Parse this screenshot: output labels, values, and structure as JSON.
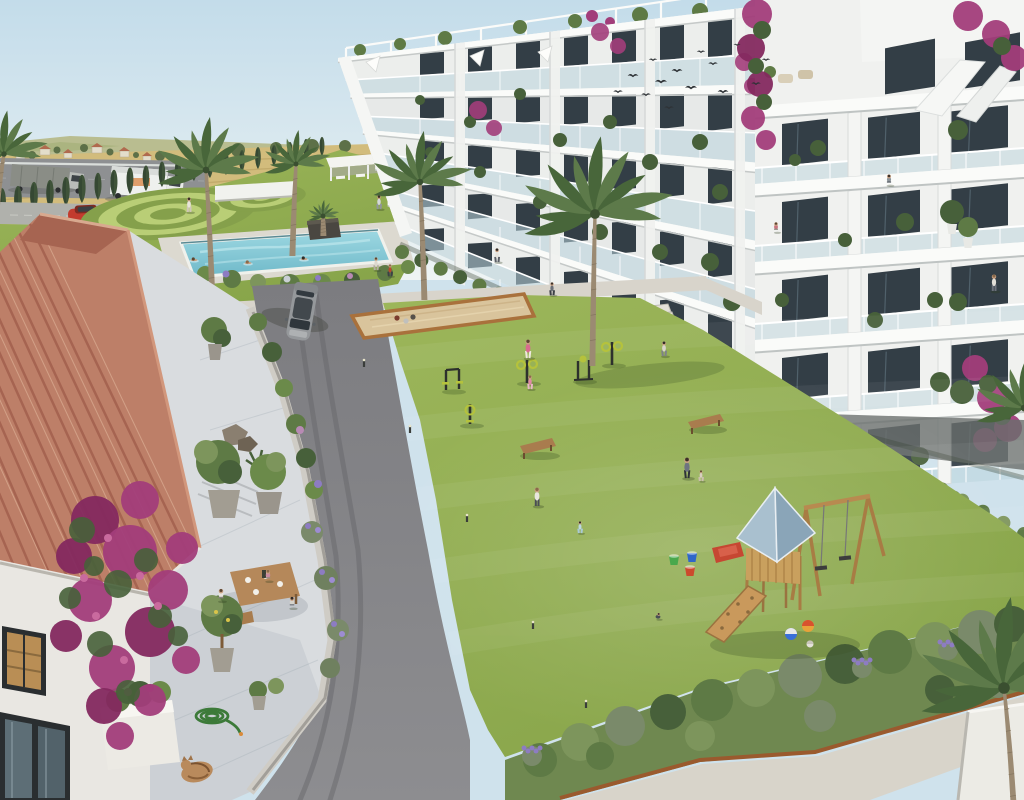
{
  "scene": {
    "title": "Aerial rendering of a Mediterranean residential complex with courtyard, pool and playground",
    "description": "3D architect visualization: white apartment blocks with glass balconies on the right, communal lawn with outdoor gym and wooden playground, swimming pool and ornamental garden at the back, country fields with a road and trucks on the horizon, and a terracotta-roofed house with a marble terrace, dining residents, a sleeping cat and bougainvillea in the left foreground.",
    "text_content": "none — the image contains no readable text"
  },
  "colors": {
    "sky_top": "#c3dcea",
    "sky_bottom": "#eaf2f3",
    "field_green": "#a9b27c",
    "field_gold": "#d2bc7c",
    "field_row": "#bfa768",
    "road_distant": "#8e9092",
    "guardrail": "#dadedb",
    "cypress": "#3f5339",
    "cypress_dark": "#324431",
    "garden_lawn": "#97ae55",
    "circle_light": "#b9ce76",
    "circle_dark": "#85a04b",
    "lawn": "#8fab4f",
    "lawn_light": "#a3bd61",
    "lawn_dark": "#7d9a44",
    "pool_water": "#83c8d6",
    "pool_water_light": "#b8e3ea",
    "pool_deck": "#dcd9d0",
    "path_concrete": "#d8d4cb",
    "asphalt": "#86868a",
    "asphalt_dark": "#77777b",
    "tire": "#68686c",
    "building_white": "#f0f1ef",
    "building_shade": "#dfe2e0",
    "slab_white": "#fafbf9",
    "window_dark": "#333e46",
    "window_frame": "#20292f",
    "glass_rail": "#b9d3dc",
    "roof_tile": "#bd7f68",
    "roof_tile_dark": "#a66451",
    "roof_tile_light": "#d8a98f",
    "wall_white": "#e9e7e2",
    "terrace_marble": "#d9dcdf",
    "terrace_vein": "#c3c9ce",
    "bougainvillea": "#a23d7a",
    "bougainvillea_dark": "#84295f",
    "foliage": "#5e7a45",
    "foliage_dark": "#47603a",
    "foliage_light": "#7d955c",
    "lavender": "#8d7cc2",
    "wood": "#c0965c",
    "wood_dark": "#9a7340",
    "play_roof_light": "#a9c0cf",
    "play_roof_dark": "#8aa5b8",
    "slide_red": "#c64732",
    "equipment_dark": "#2d302d",
    "equipment_green": "#b5c23c",
    "sand": "#d9c49c",
    "sand_border": "#a9713c",
    "corten": "#9a5a2e",
    "gravel": "#d8d4ca",
    "suv_gray": "#95989b",
    "suv_roof": "#42484d",
    "truck_white": "#eef0ee",
    "truck_tarp": "#8a8d86",
    "car_red": "#c23b2e",
    "skin": "#c9a082",
    "palm_trunk": "#9b8a72",
    "palm_green": "#5d7a4a",
    "palm_green_dark": "#48663a"
  },
  "objects": {
    "birds": [
      [
        618,
        92,
        0.8
      ],
      [
        633,
        76,
        0.9
      ],
      [
        646,
        95,
        0.8
      ],
      [
        653,
        60,
        0.7
      ],
      [
        661,
        82,
        1.0
      ],
      [
        669,
        108,
        0.8
      ],
      [
        677,
        71,
        0.9
      ],
      [
        691,
        88,
        1.0
      ],
      [
        701,
        52,
        0.7
      ],
      [
        713,
        64,
        0.8
      ],
      [
        723,
        92,
        0.9
      ],
      [
        737,
        45,
        0.6
      ],
      [
        756,
        84,
        0.8
      ],
      [
        766,
        60,
        0.7
      ]
    ],
    "cypresses": [
      [
        2,
        219,
        34
      ],
      [
        18,
        216,
        33
      ],
      [
        34,
        212,
        33
      ],
      [
        50,
        209,
        32
      ],
      [
        66,
        206,
        32
      ],
      [
        82,
        203,
        31
      ],
      [
        98,
        200,
        30
      ],
      [
        114,
        197,
        30
      ],
      [
        130,
        194,
        29
      ],
      [
        146,
        191,
        28
      ],
      [
        162,
        187,
        28
      ],
      [
        178,
        184,
        27
      ],
      [
        194,
        181,
        26
      ],
      [
        210,
        178,
        26
      ],
      [
        226,
        175,
        25
      ],
      [
        242,
        172,
        24
      ],
      [
        258,
        169,
        24
      ],
      [
        274,
        166,
        23
      ],
      [
        290,
        162,
        22
      ],
      [
        306,
        159,
        22
      ],
      [
        322,
        156,
        21
      ]
    ],
    "palms": [
      {
        "name": "palm-left",
        "x": 212,
        "y": 300,
        "t": 130,
        "r": 56,
        "lean": -6
      },
      {
        "name": "palm-small",
        "x": 292,
        "y": 256,
        "t": 92,
        "r": 36,
        "lean": 4
      },
      {
        "name": "palm-mid",
        "x": 424,
        "y": 300,
        "t": 118,
        "r": 54,
        "lean": -4
      },
      {
        "name": "palm-central",
        "x": 592,
        "y": 366,
        "t": 152,
        "r": 82,
        "lean": 3
      },
      {
        "name": "palm-corner-topleft",
        "x": -4,
        "y": 212,
        "t": 58,
        "r": 46,
        "lean": 8
      },
      {
        "name": "palm-pool-planter",
        "x": 323,
        "y": 236,
        "t": 20,
        "r": 17,
        "lean": 0
      },
      {
        "name": "palm-bottom-right",
        "x": 1014,
        "y": 818,
        "t": 130,
        "r": 96,
        "lean": -10
      },
      {
        "name": "palm-right-edge",
        "x": 1042,
        "y": 472,
        "t": 64,
        "r": 55,
        "lean": -18
      }
    ],
    "people": [
      {
        "name": "pool-deck-person",
        "x": 189,
        "y": 212,
        "h": 15,
        "pose": "stand",
        "top": "#e8e4da",
        "bottom": "#cfc6b8"
      },
      {
        "name": "swimmer-1",
        "x": 194,
        "y": 260,
        "h": 7,
        "pose": "swim",
        "top": "#c9a082",
        "bottom": "#c9a082"
      },
      {
        "name": "swimmer-2",
        "x": 248,
        "y": 263,
        "h": 7,
        "pose": "swim",
        "top": "#c9a082",
        "bottom": "#c9a082"
      },
      {
        "name": "swimmer-3",
        "x": 304,
        "y": 259,
        "h": 7,
        "pose": "swim",
        "top": "#c9a082",
        "bottom": "#c9a082"
      },
      {
        "name": "garden-walker",
        "x": 379,
        "y": 209,
        "h": 14,
        "pose": "walk",
        "top": "#d3d7d9",
        "bottom": "#90959a"
      },
      {
        "name": "lawn-person-1",
        "x": 376,
        "y": 270,
        "h": 13,
        "pose": "walk",
        "top": "#ddd8ce",
        "bottom": "#b3ada1"
      },
      {
        "name": "lawn-person-2",
        "x": 390,
        "y": 276,
        "h": 12,
        "pose": "walk",
        "top": "#b9482e",
        "bottom": "#3d4147"
      },
      {
        "name": "path-walker-building",
        "x": 497,
        "y": 262,
        "h": 14,
        "pose": "walk",
        "top": "#e6e3dc",
        "bottom": "#5b5f66"
      },
      {
        "name": "path-walker-2",
        "x": 552,
        "y": 295,
        "h": 13,
        "pose": "walk",
        "top": "#6b7077",
        "bottom": "#3c4046"
      },
      {
        "name": "woman-pink",
        "x": 528,
        "y": 358,
        "h": 19,
        "pose": "walk",
        "top": "#d96a8f",
        "bottom": "#efe9df"
      },
      {
        "name": "girl-pink",
        "x": 530,
        "y": 389,
        "h": 14,
        "pose": "walk",
        "top": "#e08aa6",
        "bottom": "#e8b9c8"
      },
      {
        "name": "path-person-right",
        "x": 664,
        "y": 356,
        "h": 15,
        "pose": "walk",
        "top": "#d9d5cb",
        "bottom": "#7e8288"
      },
      {
        "name": "woman-cardigan",
        "x": 687,
        "y": 478,
        "h": 21,
        "pose": "walk",
        "top": "#6e7480",
        "bottom": "#2e3238"
      },
      {
        "name": "toddler",
        "x": 701,
        "y": 481,
        "h": 11,
        "pose": "walk",
        "top": "#d9cfc0",
        "bottom": "#cbbfae"
      },
      {
        "name": "woman-by-bench",
        "x": 537,
        "y": 506,
        "h": 19,
        "pose": "stand",
        "top": "#e9e6df",
        "bottom": "#4a4e55"
      },
      {
        "name": "toddler-blue",
        "x": 580,
        "y": 533,
        "h": 12,
        "pose": "walk",
        "top": "#bcd8e2",
        "bottom": "#a9c9d6"
      },
      {
        "name": "child-playing",
        "x": 658,
        "y": 619,
        "h": 11,
        "pose": "crouch",
        "top": "#4a4f55",
        "bottom": "#6b6f75"
      },
      {
        "name": "diner-left",
        "x": 221,
        "y": 601,
        "h": 15,
        "pose": "sit",
        "top": "#e8e5dd",
        "bottom": "#8a8580"
      },
      {
        "name": "diner-back",
        "x": 268,
        "y": 581,
        "h": 14,
        "pose": "sit",
        "top": "#c98ba0",
        "bottom": "#9a8f85"
      },
      {
        "name": "diner-right",
        "x": 292,
        "y": 608,
        "h": 14,
        "pose": "sit",
        "top": "#d7d4cc",
        "bottom": "#7d8187"
      },
      {
        "name": "balcony-worker",
        "x": 889,
        "y": 185,
        "h": 13,
        "pose": "sit",
        "top": "#8a9298",
        "bottom": "#5a6168"
      },
      {
        "name": "balcony-sitter",
        "x": 776,
        "y": 232,
        "h": 12,
        "pose": "sit",
        "top": "#c9737f",
        "bottom": "#8a8078"
      },
      {
        "name": "balcony-stander",
        "x": 994,
        "y": 291,
        "h": 17,
        "pose": "stand",
        "top": "#e2dfd8",
        "bottom": "#6b707a"
      }
    ],
    "bollards": [
      [
        364,
        367
      ],
      [
        410,
        433
      ],
      [
        467,
        522
      ],
      [
        533,
        629
      ],
      [
        586,
        708
      ]
    ],
    "bocce_balls": [
      [
        397,
        318,
        "#7a3b2e"
      ],
      [
        406,
        321,
        "#c0c0bd"
      ],
      [
        413,
        317,
        "#55504a"
      ]
    ],
    "play_balls": [
      [
        791,
        634,
        6,
        "#3a6fd8",
        "#e8e8e8"
      ],
      [
        808,
        626,
        6,
        "#e8a23a",
        "#d8522e"
      ],
      [
        810,
        644,
        3.5,
        "#e5e2da",
        "#c9c5ba"
      ]
    ],
    "buckets": [
      [
        674,
        561,
        "#49a84c"
      ],
      [
        692,
        558,
        "#2f66c9"
      ],
      [
        690,
        572,
        "#cc4a2d"
      ]
    ],
    "vehicles": [
      {
        "name": "suv-parked"
      },
      {
        "name": "white-box-truck"
      },
      {
        "name": "tarp-truck"
      },
      {
        "name": "red-car"
      }
    ]
  }
}
